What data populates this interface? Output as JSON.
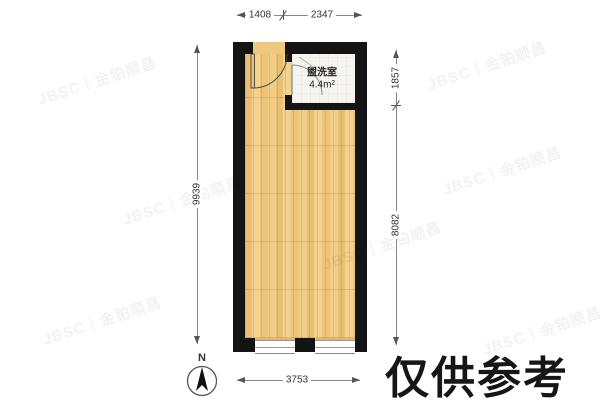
{
  "washroom": {
    "name": "盥洗室",
    "area": "4.4m²"
  },
  "dimensions": {
    "top": [
      "1408",
      "2347"
    ],
    "bottom": [
      "3753"
    ],
    "left": [
      "9939"
    ],
    "right": [
      "1857",
      "8082"
    ]
  },
  "compass": {
    "label": "N"
  },
  "watermark": {
    "brand": "JBSC｜金铂顺昌",
    "notice": "仅供参考"
  },
  "colors": {
    "wall": "#141414",
    "floor_wood": "#eec87f",
    "washroom_floor": "#f5f4f1",
    "dim_text": "#333333",
    "notice_text": "#161616"
  }
}
